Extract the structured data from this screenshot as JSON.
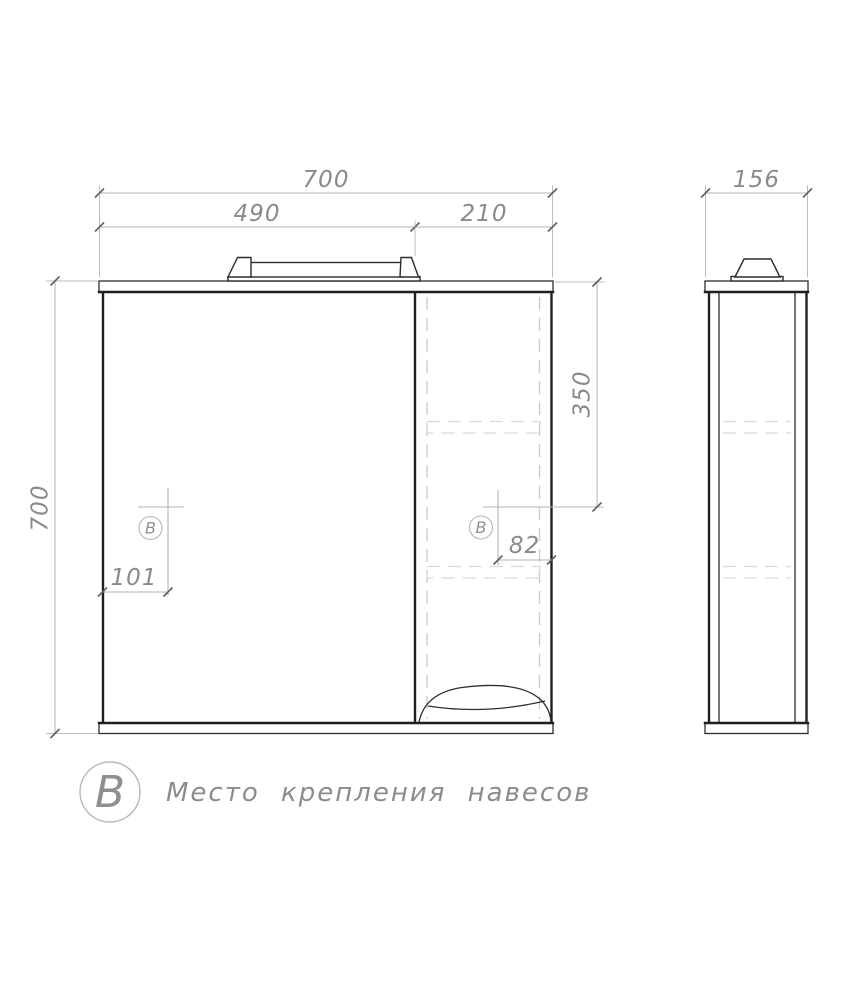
{
  "front_view": {
    "dim_width_total": "700",
    "dim_width_left": "490",
    "dim_width_right": "210",
    "dim_height_total": "700",
    "dim_mount_from_top": "350",
    "dim_mount_from_right": "82",
    "dim_mount_from_left": "101",
    "mount_symbol": "B"
  },
  "side_view": {
    "dim_depth": "156"
  },
  "legend": {
    "symbol": "B",
    "label": "Место крепления навесов"
  },
  "colors": {
    "background": "#ffffff",
    "object_line": "#1f1f1f",
    "dimension_line": "#b3b3b3",
    "dimension_text": "#8a8a8a",
    "hidden_line": "#c9c9c9",
    "mount_marker": "#b5b5b5"
  }
}
